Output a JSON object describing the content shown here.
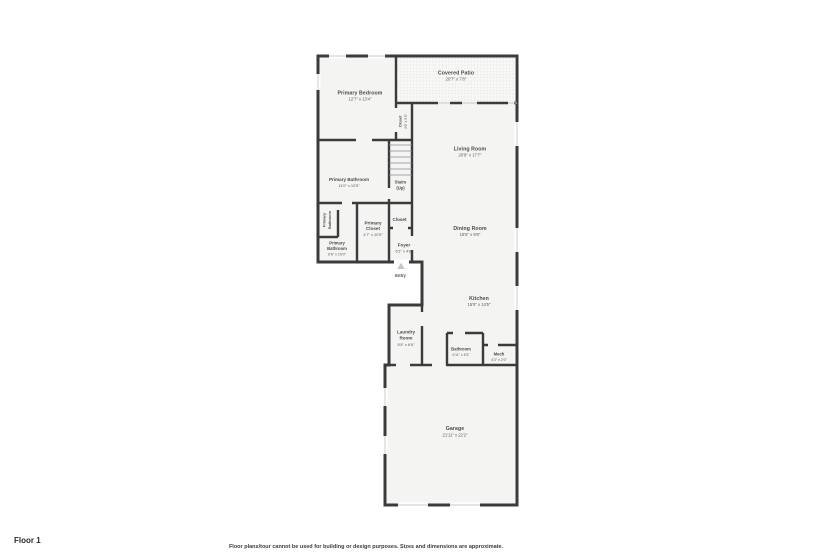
{
  "colors": {
    "wall": "#3b3b3b",
    "room_fill": "#f4f4f3",
    "patio_dot": "#d9d9d9",
    "label_text": "#4a4a4a",
    "window_line": "#c8c8c8"
  },
  "footer": {
    "floor_label": "Floor 1",
    "disclaimer": "Floor plans/tour cannot be used for building or design purposes. Sizes and dimensions are approximate."
  },
  "rooms": {
    "primary_bedroom": {
      "name": "Primary Bedroom",
      "dims": "12'7\" x 13'4\""
    },
    "covered_patio": {
      "name": "Covered Patio",
      "dims": "20'7\" x 7'8\""
    },
    "closet_upper": {
      "name": "Closet",
      "dims": "2'6\" x 5'5\""
    },
    "living_room": {
      "name": "Living Room",
      "dims": "20'8\" x 17'7\""
    },
    "primary_bathroom": {
      "name": "Primary Bathroom",
      "dims": "11'0\" x 10'5\""
    },
    "stairs": {
      "name": "Stairs",
      "modifier": "(Up)"
    },
    "primary_bathroom_2": {
      "line1": "Primary",
      "line2": "Bathroom"
    },
    "primary_closet": {
      "line1": "Primary",
      "line2": "Closet",
      "dims": "4'7\" x 10'5\""
    },
    "closet_hall": {
      "name": "Closet"
    },
    "primary_bathroom_3": {
      "line1": "Primary",
      "line2": "Bathroom",
      "dims": "6'6\" x 10'0\""
    },
    "foyer": {
      "name": "Foyer",
      "dims": "6'1\" x 4'8\""
    },
    "entry": {
      "name": "Entry"
    },
    "dining_room": {
      "name": "Dining Room",
      "dims": "16'5\" x 9'8\""
    },
    "kitchen": {
      "name": "Kitchen",
      "dims": "15'9\" x 14'5\""
    },
    "laundry_room": {
      "line1": "Laundry",
      "line2": "Room",
      "dims": "5'4\" x 6'6\""
    },
    "bathroom": {
      "name": "Bathroom",
      "dims": "4'11\" x 5'3\""
    },
    "mech": {
      "name": "Mech",
      "dims": "4'3\" x 2'0\""
    },
    "garage": {
      "name": "Garage",
      "dims": "21'11\" x 22'2\""
    }
  }
}
